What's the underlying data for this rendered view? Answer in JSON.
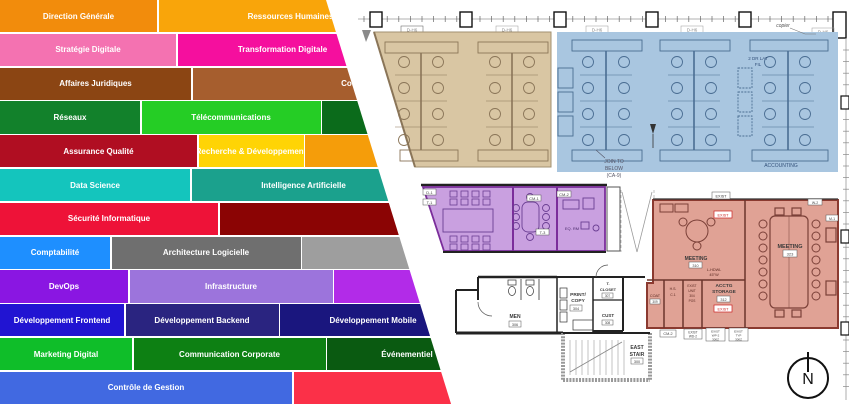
{
  "org": {
    "rows": [
      {
        "segments": [
          {
            "label": "Direction Générale",
            "color": "#F28C0C",
            "width": 157
          },
          {
            "label": "Ressources Humaines",
            "color": "#F9A50A",
            "width": 264
          }
        ]
      },
      {
        "segments": [
          {
            "label": "Stratégie Digitale",
            "color": "#F472B1",
            "width": 176
          },
          {
            "label": "Transformation Digitale",
            "color": "#F50F9E",
            "width": 210
          }
        ]
      },
      {
        "segments": [
          {
            "label": "Affaires Juridiques",
            "color": "#8B4513",
            "width": 191
          },
          {
            "label": "Conformité",
            "color": "#A65E2E",
            "width": 340
          }
        ]
      },
      {
        "segments": [
          {
            "label": "Réseaux",
            "color": "#12812B",
            "width": 140
          },
          {
            "label": "Télécommunications",
            "color": "#25CD25",
            "width": 179
          },
          {
            "label": "",
            "color": "#0B6B1B",
            "width": 130
          }
        ]
      },
      {
        "segments": [
          {
            "label": "Assurance Qualité",
            "color": "#B00E22",
            "width": 197
          },
          {
            "label": "Recherche & Développement",
            "color": "#FFD405",
            "width": 105
          },
          {
            "label": "",
            "color": "#F59D0A",
            "width": 130
          }
        ]
      },
      {
        "segments": [
          {
            "label": "Data Science",
            "color": "#14C5BD",
            "width": 190
          },
          {
            "label": "Intelligence Artificielle",
            "color": "#1BA18D",
            "width": 224
          }
        ]
      },
      {
        "segments": [
          {
            "label": "Sécurité Informatique",
            "color": "#EE1238",
            "width": 218
          },
          {
            "label": "",
            "color": "#8B0404",
            "width": 210
          }
        ]
      },
      {
        "segments": [
          {
            "label": "Comptabilité",
            "color": "#1E8FFF",
            "width": 110
          },
          {
            "label": "Architecture Logicielle",
            "color": "#6F6F6F",
            "width": 189
          },
          {
            "label": "",
            "color": "#9E9E9E",
            "width": 130
          }
        ]
      },
      {
        "segments": [
          {
            "label": "DevOps",
            "color": "#8A16E2",
            "width": 128
          },
          {
            "label": "Infrastructure",
            "color": "#9C74DC",
            "width": 203
          },
          {
            "label": "",
            "color": "#B22BE8",
            "width": 110
          }
        ]
      },
      {
        "segments": [
          {
            "label": "Développement Frontend",
            "color": "#2114D2",
            "width": 124
          },
          {
            "label": "Développement Backend",
            "color": "#2A2480",
            "width": 153
          },
          {
            "label": "Développement Mobile",
            "color": "#1A167E",
            "width": 186
          }
        ]
      },
      {
        "segments": [
          {
            "label": "Marketing Digital",
            "color": "#0FBE29",
            "width": 132
          },
          {
            "label": "Communication Corporate",
            "color": "#0D8013",
            "width": 192
          },
          {
            "label": "Événementiel",
            "color": "#0A5A11",
            "width": 160
          }
        ]
      },
      {
        "segments": [
          {
            "label": "Contrôle de Gestion",
            "color": "#4169E1",
            "width": 292
          },
          {
            "label": "",
            "color": "#FB3048",
            "width": 170
          }
        ]
      }
    ]
  },
  "plan": {
    "zone_colors": {
      "tan": "#D9C6A3",
      "blue": "#A9C6E0",
      "purple": "#C9A0E0",
      "purple_border": "#7B2D9B",
      "red": "#E0A295",
      "red_border": "#8B3A30"
    },
    "grid_tag": "D-H6",
    "copier_note": "copier",
    "lat_file_line1": "2 DR LAT",
    "lat_file_line2": "FIL",
    "accounting_label": "ACCOUNTING",
    "join_note": {
      "line1": "JOIN TO",
      "line2": "BELOW",
      "line3": "(CA-9)"
    },
    "meeting_small": {
      "label": "MEETING",
      "number": "310"
    },
    "meeting_large": {
      "label": "MEETING",
      "number": "323"
    },
    "acctg_storage": {
      "line1": "ACCTG",
      "line2": "STORAGE",
      "number": "312",
      "tag": "EXIST"
    },
    "exist_tag": "EXIST",
    "hardware_note": {
      "line1": "L-HDWL",
      "line2": "45°W"
    },
    "small_rooms": {
      "hs": "H.S.",
      "c1": "C.1",
      "unit": [
        "EXIST",
        "UNIT",
        "304",
        "POS"
      ],
      "coat": "COAT",
      "coat_number": "309"
    },
    "men": {
      "label": "MEN",
      "number": "306"
    },
    "print_copy": {
      "line1": "PRINT/",
      "line2": "COPY",
      "number": "304"
    },
    "closet": {
      "line1": "T.",
      "line2": "CLOSET",
      "number": "307"
    },
    "cust": {
      "label": "CUST",
      "number": "308"
    },
    "east_stair": {
      "line1": "EAST",
      "line2": "STAIR",
      "number": "300"
    },
    "wall_tags": {
      "tag1": "CM-2",
      "tag2_l1": "EXIST",
      "tag2_l2": "WD-2",
      "tag3_l1": "EXIST",
      "tag3_l2": "WP-2",
      "tag3_l3": "300Z",
      "tag4_l1": "EXIST",
      "tag4_l2": "TYP",
      "tag4_l3": "300Z"
    },
    "purple_tags": {
      "d1": "D-1",
      "t1": "T-1",
      "cm1": "CM-1",
      "cm2": "CM-2",
      "t3": "T-3",
      "eq_rm": "EQ. RM"
    },
    "red_tags": {
      "w2": "W-2",
      "m1": "M-1"
    },
    "compass": "N"
  }
}
